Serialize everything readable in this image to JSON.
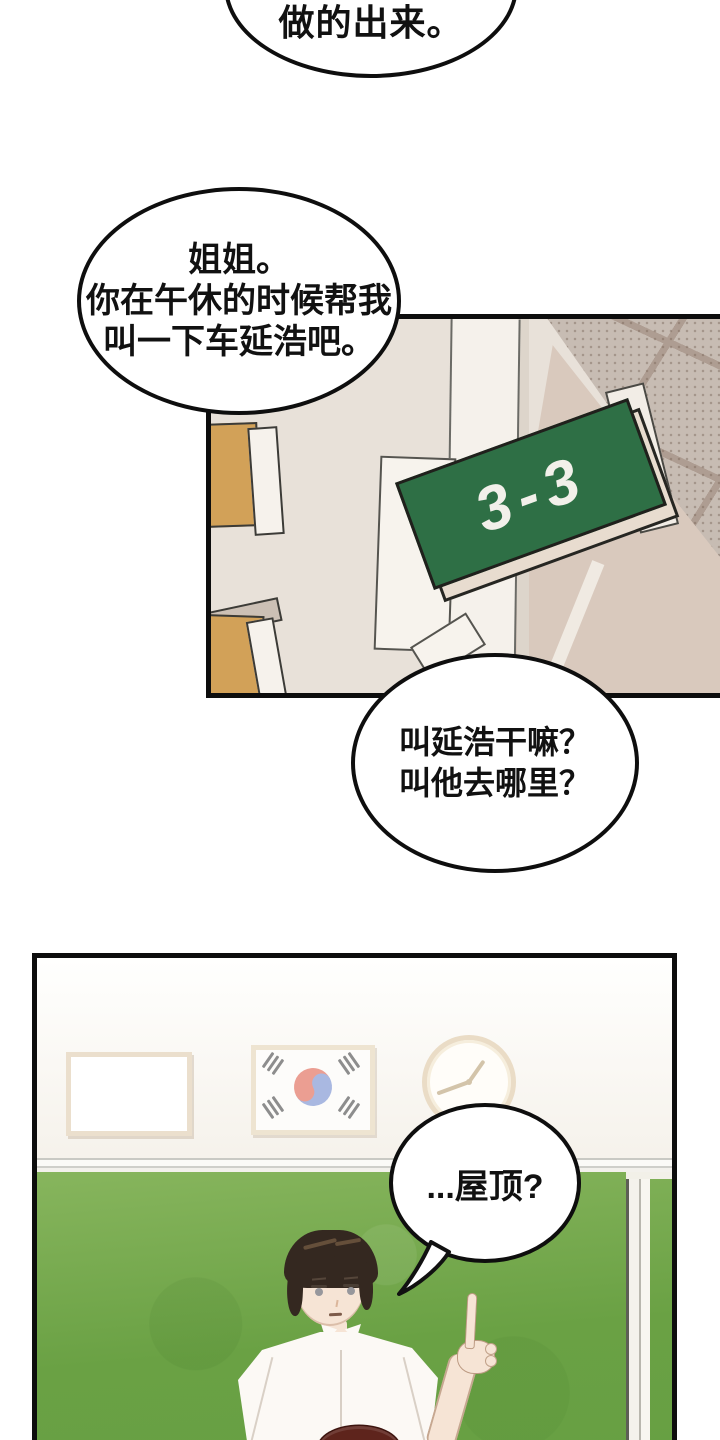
{
  "page_type": "webtoon-comic-page",
  "bubbles": {
    "top": {
      "text": "做的出来。"
    },
    "request": {
      "lines": [
        "姐姐。",
        "你在午休的时候帮我",
        "叫一下车延浩吧。"
      ]
    },
    "question": {
      "lines": [
        "叫延浩干嘛？",
        "叫他去哪里？"
      ]
    },
    "answer": {
      "text": "...屋顶?"
    }
  },
  "hallway_panel": {
    "classroom_sign": "3-3"
  },
  "classroom_panel": {
    "wall_items": [
      "whiteboard",
      "korean-flag",
      "wall-clock"
    ],
    "characters": [
      "boy-pointing-up",
      "second-person-head"
    ]
  },
  "colors": {
    "sign_green": "#2e6f45",
    "chalkboard_green": "#6fa44a",
    "ceiling_tile": "#c7bcb3",
    "wall_beige": "#e8e1d9",
    "dark_wall": "#d9c9bd",
    "wood_tan": "#d2a158",
    "taegeuk_red": "#eb9e92",
    "taegeuk_blue": "#a9b8e1",
    "hair_dark": "#342820",
    "second_head_hair": "#5e241c",
    "skin": "#f6e4d5",
    "outline_black": "#0d0d0d"
  }
}
